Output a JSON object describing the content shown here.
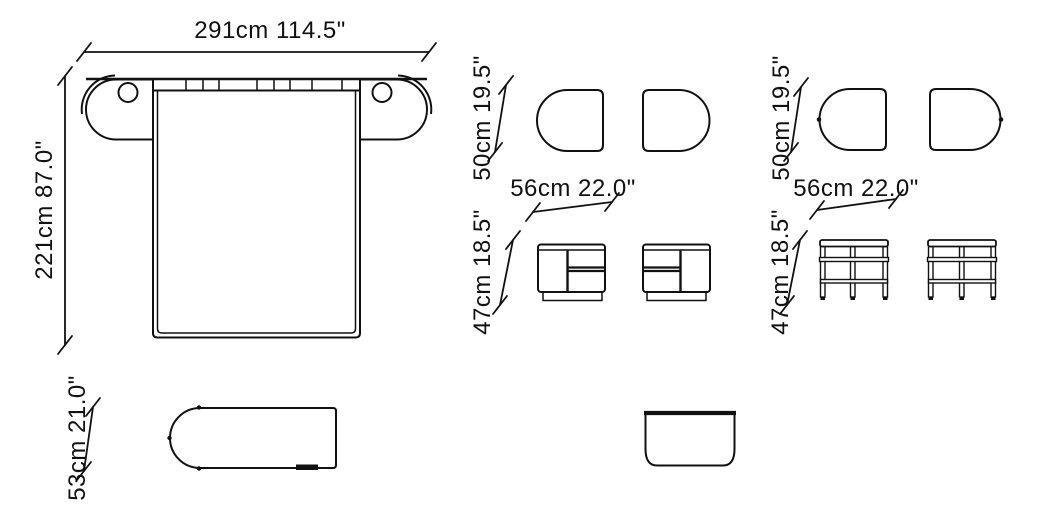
{
  "canvas": {
    "background": "#ffffff",
    "line_color": "#111111"
  },
  "bed": {
    "top_view": {
      "width_dim": "291cm 114.5\"",
      "depth_dim": "221cm 87.0\""
    },
    "side_view": {
      "height_dim": "53cm 21.0\""
    }
  },
  "nightstand_closed": {
    "top_view": {
      "depth_dim": "50cm 19.5\"",
      "width_dim": "56cm 22.0\""
    },
    "front_view": {
      "height_dim": "47cm 18.5\""
    }
  },
  "nightstand_open": {
    "top_view": {
      "depth_dim": "50cm 19.5\"",
      "width_dim": "56cm 22.0\""
    },
    "front_view": {
      "height_dim": "47cm 18.5\""
    }
  }
}
